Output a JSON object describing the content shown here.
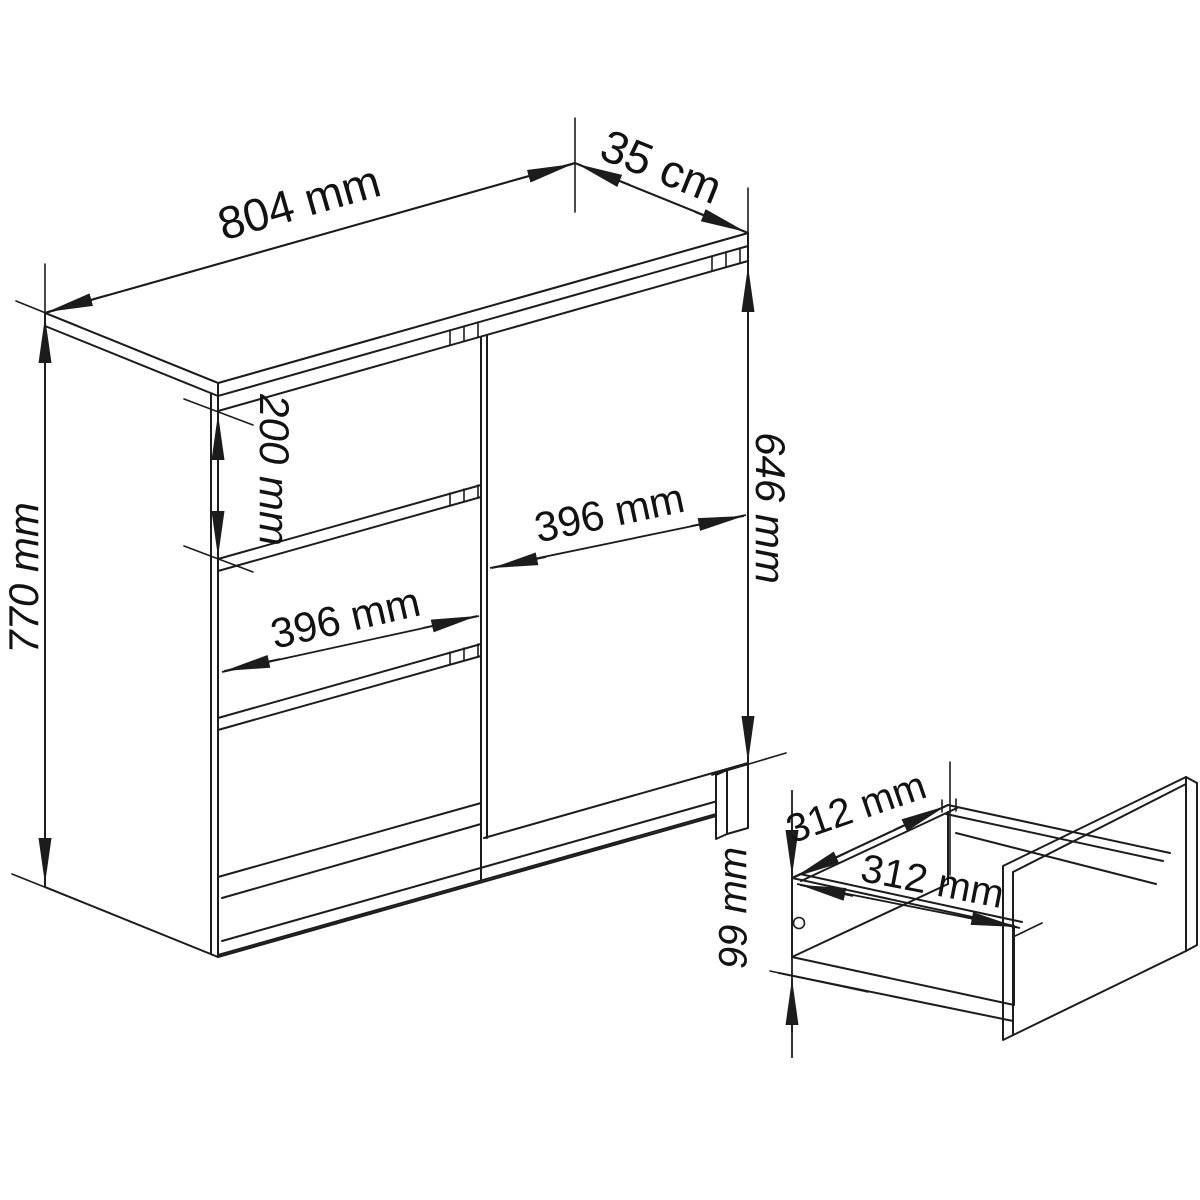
{
  "colors": {
    "background": "#ffffff",
    "line": "#1c1c1c",
    "text": "#121212"
  },
  "views": {
    "cabinet": {
      "dims": {
        "width": "804 mm",
        "depth": "35 cm",
        "height": "770 mm",
        "top_drawer_height": "200 mm",
        "drawer_front_width": "396 mm",
        "door_width": "396 mm",
        "door_height": "646 mm"
      }
    },
    "drawer_detail": {
      "dims": {
        "inner_width": "312 mm",
        "inner_depth": "312 mm",
        "side_height": "99 mm"
      }
    }
  }
}
